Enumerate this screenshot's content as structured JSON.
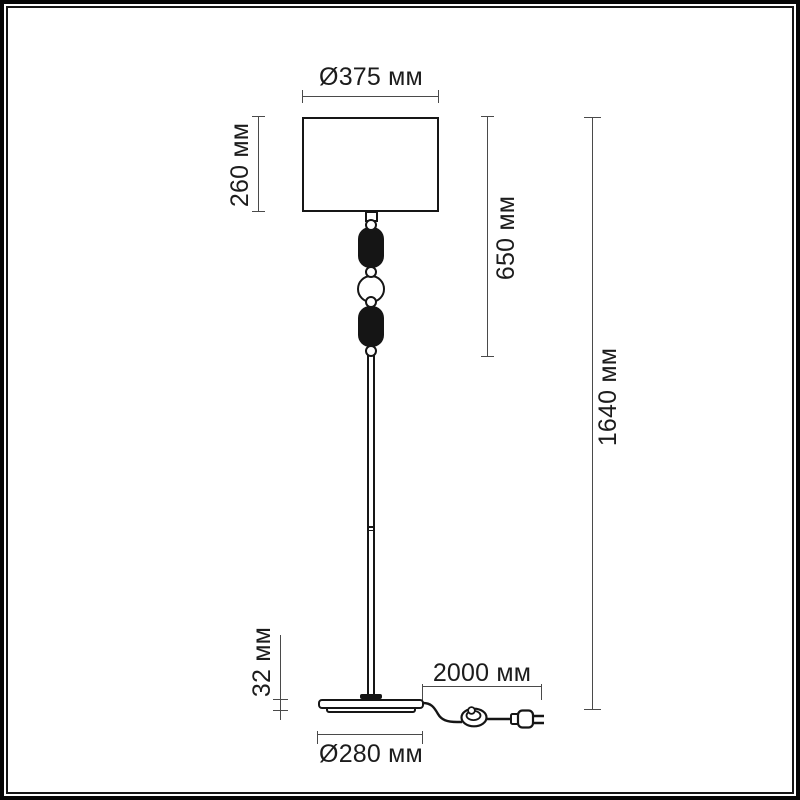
{
  "diagram": {
    "type": "technical-dimension-drawing",
    "subject": "floor lamp with shade, decorative glass stem, round base, foot switch and plug",
    "labels": {
      "shade_diameter": "Ø375 мм",
      "shade_height": "260 мм",
      "upper_section_height": "650 мм",
      "total_height": "1640 мм",
      "base_height": "32 мм",
      "cable_length": "2000 мм",
      "base_diameter": "Ø280 мм"
    },
    "colors": {
      "background": "#ffffff",
      "drawing_line": "#161616",
      "dimension_line": "#4a4a4a",
      "text": "#1c1c1c",
      "frame": "#060606"
    }
  }
}
